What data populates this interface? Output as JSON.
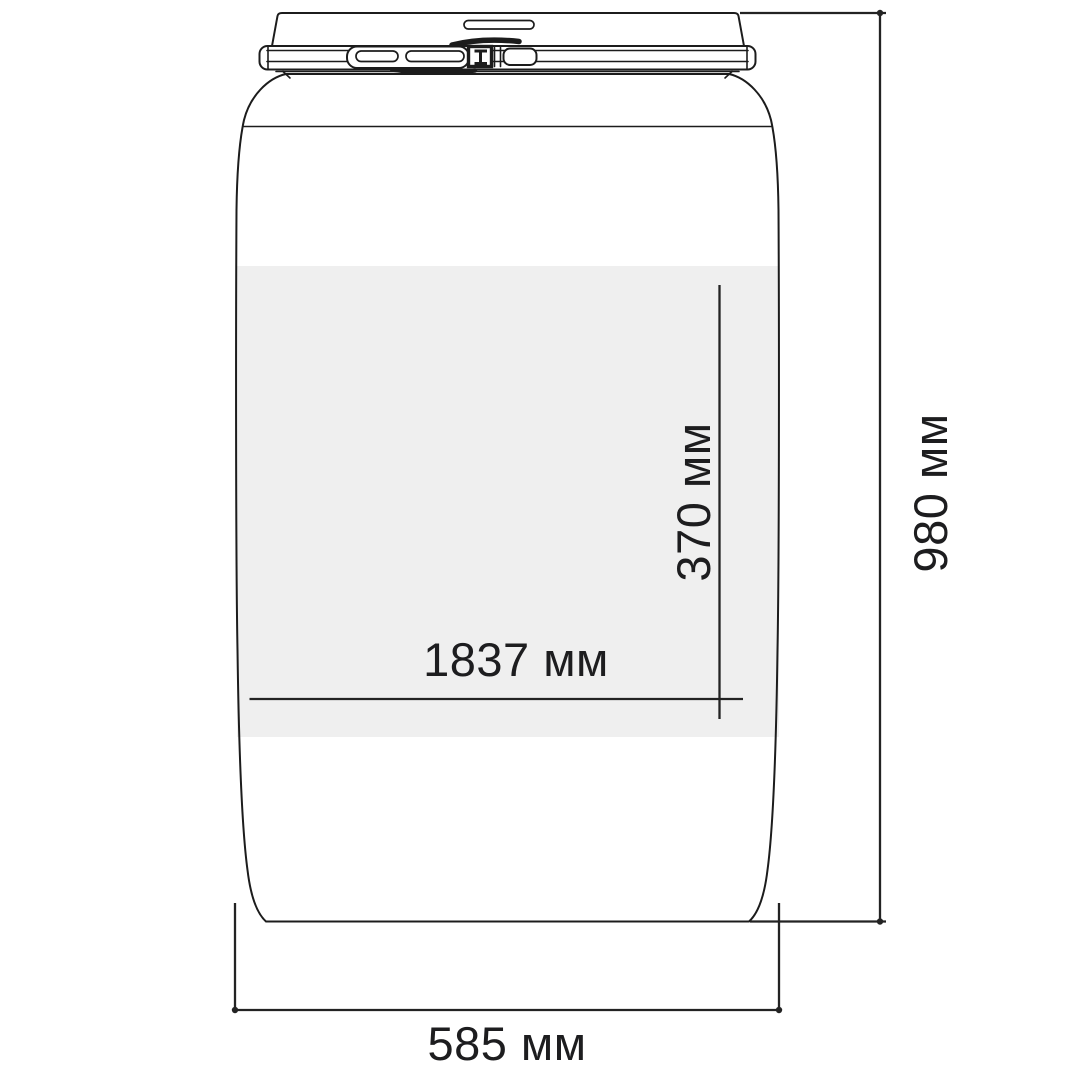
{
  "drawing": {
    "subject": "plastic-barrel-with-clamp-ring-lid",
    "background_color": "#ffffff",
    "line_color": "#1c1c1c",
    "dimension_line_color": "#232323",
    "label_area_color": "#efefef",
    "text_color": "#1d1d1f"
  },
  "dimensions": {
    "label_area_width": {
      "value": "1837 мм",
      "orientation": "horizontal",
      "applies_to": "label-area-width"
    },
    "label_area_height": {
      "value": "370 мм",
      "orientation": "vertical",
      "applies_to": "label-area-height"
    },
    "overall_height": {
      "value": "980 мм",
      "orientation": "vertical",
      "applies_to": "barrel-total-height"
    },
    "overall_width": {
      "value": "585 мм",
      "orientation": "horizontal",
      "applies_to": "barrel-total-width"
    }
  }
}
